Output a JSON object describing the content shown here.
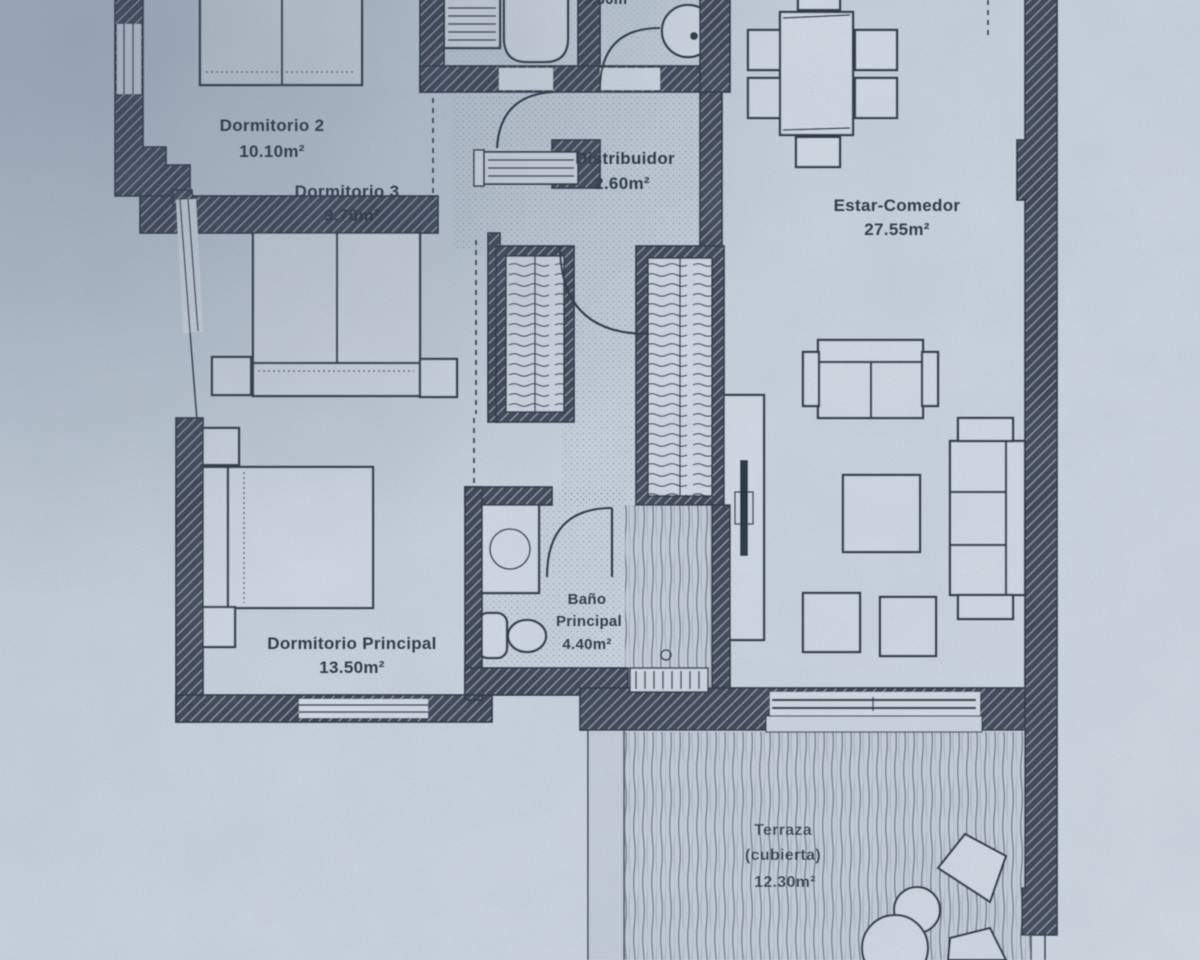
{
  "plan": {
    "top_partial_label": "3.30m²",
    "rooms": [
      {
        "name": "Dormitorio 2",
        "area": "10.10m²"
      },
      {
        "name": "Dormitorio 3",
        "area": "9.70m²"
      },
      {
        "name": "Distribuidor",
        "area": "2.60m²"
      },
      {
        "name": "Estar-Comedor",
        "area": "27.55m²"
      },
      {
        "name": "Dormitorio Principal",
        "area": "13.50m²"
      },
      {
        "name": "Baño",
        "name_line2": "Principal",
        "area": "4.40m²"
      },
      {
        "name": "Terraza",
        "name_line2": "(cubierta)",
        "area": "12.30m²"
      }
    ],
    "colors": {
      "paper": "#ccd5e0",
      "ink": "#27303d",
      "wall": "#3a4150",
      "hatch": "#9aa5b5",
      "furn": "#d7dee7"
    }
  }
}
